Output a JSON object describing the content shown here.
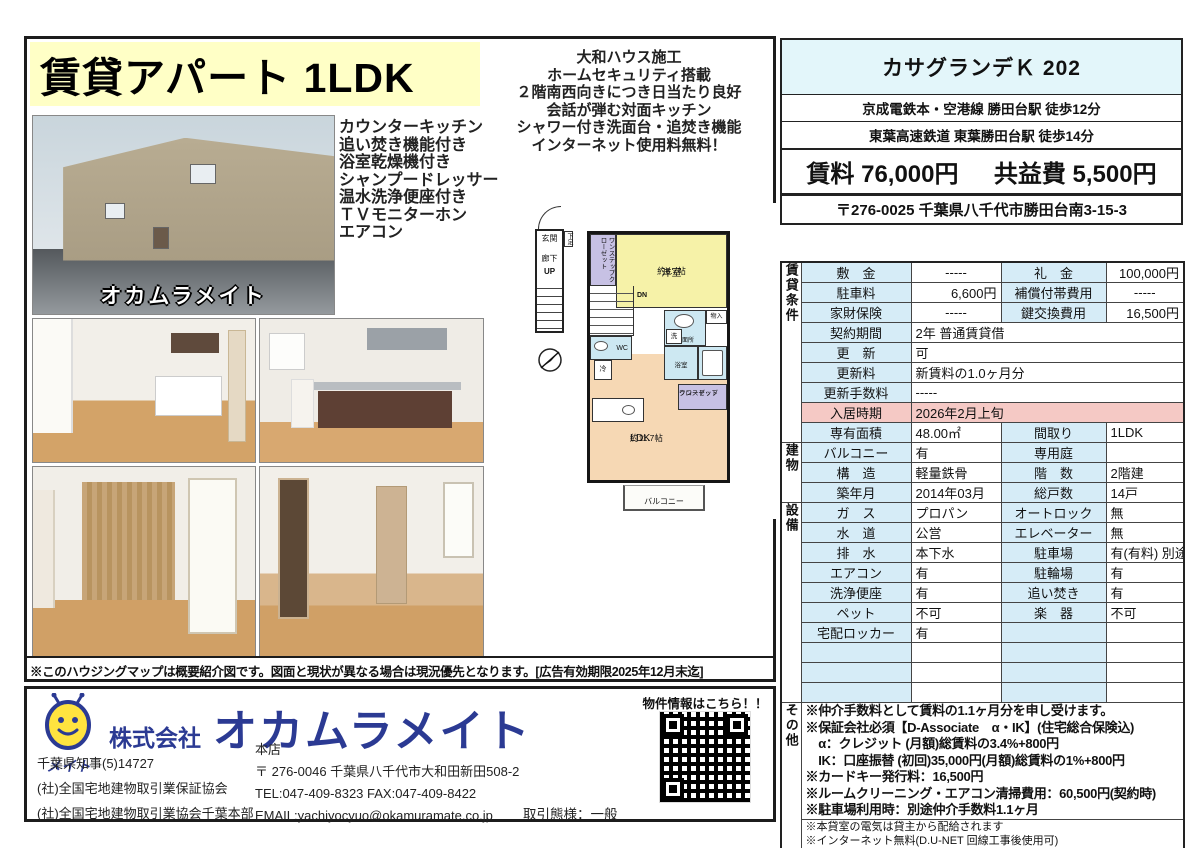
{
  "flyer": {
    "title": "賃貸アパート 1LDK",
    "highlights": [
      "大和ハウス施工",
      "ホームセキュリティ搭載",
      "２階南西向きにつき日当たり良好",
      "会話が弾む対面キッチン",
      "シャワー付き洗面台・追焚き機能",
      "インターネット使用料無料！"
    ],
    "features": [
      "カウンターキッチン",
      "追い焚き機能付き",
      "浴室乾燥機付き",
      "シャンプードレッサー",
      "温水洗浄便座付き",
      "ＴＶモニターホン",
      "エアコン"
    ],
    "watermark": "オカムラメイト",
    "disclaimer": "※このハウジングマップは概要紹介図です。図面と現状が異なる場合は現況優先となります。[広告有効期限2025年12月末迄]"
  },
  "header": {
    "name": "カサグランデＫ 202",
    "access1": "京成電鉄本・空港線 勝田台駅 徒歩12分",
    "access2": "東葉高速鉄道 東葉勝田台駅 徒歩14分",
    "rent_label": "賃料",
    "rent": "76,000円",
    "fee_label": "共益費",
    "fee": "5,500円",
    "address": "〒276-0025 千葉県八千代市勝田台南3-15-3"
  },
  "floorplan": {
    "entrance": "玄関",
    "shoe": "下足",
    "corridor": "廊下",
    "up": "UP",
    "dn": "DN",
    "closet_vertical": "ワンステップクローゼット",
    "west_room": "洋室",
    "west_room_size": "約6.7帖",
    "wc": "WC",
    "washroom": "洗面所",
    "washer": "洗",
    "storage": "物入",
    "bath": "浴室",
    "closet2_line1": "ワンステップ",
    "closet2_line2": "クローゼット",
    "fridge": "冷",
    "ldk": "LDK",
    "ldk_size": "約11.7帖",
    "balcony": "バルコニー"
  },
  "table": {
    "sec_lease": "賃貸条件",
    "sec_building": "建物",
    "sec_equipment": "設備",
    "sec_other": "その他",
    "lease": [
      [
        "敷　金",
        "-----",
        "礼　金",
        "100,000円"
      ],
      [
        "駐車料",
        "6,600円",
        "補償付帯費用",
        "-----"
      ],
      [
        "家財保険",
        "-----",
        "鍵交換費用",
        "16,500円"
      ],
      [
        "契約期間",
        "2年 普通賃貸借"
      ],
      [
        "更　新",
        "可"
      ],
      [
        "更新料",
        "新賃料の1.0ヶ月分"
      ],
      [
        "更新手数料",
        "-----"
      ],
      [
        "入居時期",
        "2026年2月上旬"
      ],
      [
        "専有面積",
        "48.00㎡",
        "間取り",
        "1LDK"
      ]
    ],
    "building": [
      [
        "バルコニー",
        "有",
        "専用庭",
        ""
      ],
      [
        "構　造",
        "軽量鉄骨",
        "階　数",
        "2階建"
      ],
      [
        "築年月",
        "2014年03月",
        "総戸数",
        "14戸"
      ]
    ],
    "equipment": [
      [
        "ガ　ス",
        "プロパン",
        "オートロック",
        "無"
      ],
      [
        "水　道",
        "公営",
        "エレベーター",
        "無"
      ],
      [
        "排　水",
        "本下水",
        "駐車場",
        "有(有料) 別途契"
      ],
      [
        "エアコン",
        "有",
        "駐輪場",
        "有"
      ],
      [
        "洗浄便座",
        "有",
        "追い焚き",
        "有"
      ],
      [
        "ペット",
        "不可",
        "楽　器",
        "不可"
      ],
      [
        "宅配ロッカー",
        "有",
        "",
        ""
      ],
      [
        "",
        "",
        "",
        ""
      ],
      [
        "",
        "",
        "",
        ""
      ],
      [
        "",
        "",
        "",
        ""
      ]
    ],
    "other_notes": [
      "※仲介手数料として賃料の1.1ヶ月分を申し受けます。",
      "※保証会社必須【D-Associate　α・IK】(住宅総合保険込)",
      "　α：クレジット (月額)総賃料の3.4%+800円",
      "　IK：口座振替 (初回)35,000円(月額)総賃料の1%+800円",
      "※カードキー発行料：16,500円",
      "※ルームクリーニング・エアコン清掃費用：60,500円(契約時)",
      "※駐車場利用時：別途仲介手数料1.1ヶ月"
    ],
    "bottom_notes": [
      "※本貸室の電気は貸主から配給されます",
      "※インターネット無料(D.U-NET 回線工事後使用可)"
    ]
  },
  "company": {
    "logo_text": "メイト",
    "prefix": "株式会社",
    "name": "オカムラメイト",
    "license": "千葉県知事(5)14727",
    "assoc1": "(社)全国宅地建物取引業保証協会",
    "assoc2": "(社)全国宅地建物取引業協会千葉本部",
    "office": "本店",
    "office_address": "〒 276-0046 千葉県八千代市大和田新田508-2",
    "tel_fax": "TEL:047-409-8323 FAX:047-409-8422",
    "email": "EMAIL:yachiyocyuo@okamuramate.co.jp",
    "deal_type": "取引態様：一般",
    "qr_caption": "物件情報はこちら！！"
  },
  "colors": {
    "brand_blue": "#2b3a93",
    "label_cell": "#d6ecf7",
    "header_cyan": "#e3f6fa",
    "title_yellow": "#ffffc6",
    "move_in_pink": "#f5c9c5",
    "room_yellow": "#f6f2a8",
    "room_peach": "#f6d8b4",
    "room_blue": "#cde8f2",
    "room_purple": "#c7c1e4"
  }
}
